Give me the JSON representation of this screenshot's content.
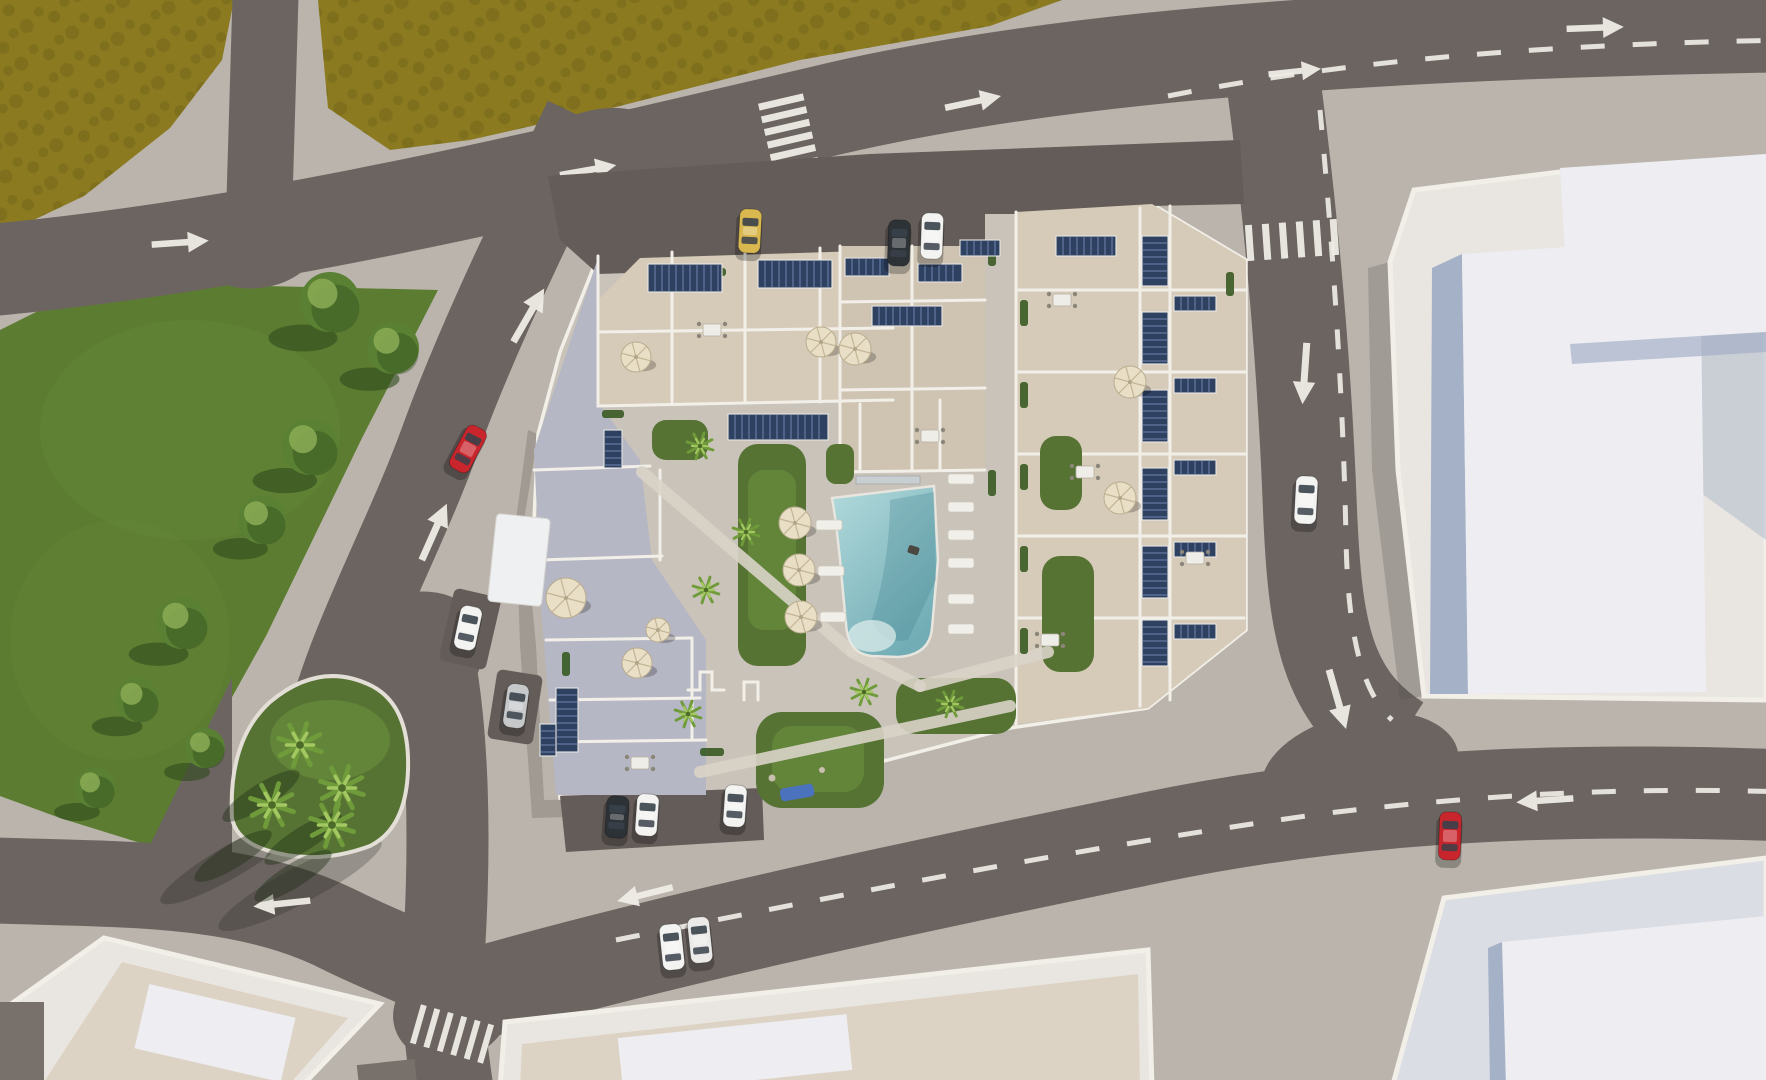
{
  "meta": {
    "scene_type": "aerial-architectural-render",
    "description": "Top-down 3D visualization of a residential apartment complex with rooftop terraces, solar panels, parasols and a central courtyard pool, surrounded by roads, a park and neighbouring flat-roof buildings",
    "visible_text": ""
  },
  "palette": {
    "sidewalk": "#bab4ac",
    "road": "#6b6460",
    "road_dark": "#635c58",
    "field": "#8b7a20",
    "field_dark": "#73651a",
    "park": "#5c7d31",
    "park_dark": "#35511f",
    "tree": "#59803306",
    "tree_fill": "#598033",
    "tree_dark": "#2e4a1d",
    "grass": "#567334",
    "grass_light": "#6e9340",
    "plot": "#c9c3b9",
    "beige": "#d6cbb9",
    "beige2": "#cfc4b2",
    "lilac": "#b6b7c4",
    "wall": "#f2efe9",
    "court_path": "#d9d3c8",
    "solar": "#2f4160",
    "solar_line": "#7b92bd",
    "pool_light": "#b2dadc",
    "pool_deep": "#72adb5",
    "pool_bar": "#c9ced1",
    "umbrella": "#e9dec6",
    "umbrella_line": "#c3b596",
    "bldg_white": "#e9e6e1",
    "roof_cream": "#ddd3c4",
    "lavender": "#dbdde4",
    "raised": "#ededf2",
    "shade_blue": "#a5b1c7",
    "marking": "#efece6"
  },
  "scene": {
    "cars": [
      {
        "name": "red-car-avenue",
        "color": "#c8252c",
        "x": 468,
        "y": 449,
        "rot": 28,
        "len": 48
      },
      {
        "name": "white-car-east-road",
        "color": "#f3f3f2",
        "x": 1306,
        "y": 500,
        "rot": 3,
        "len": 48
      },
      {
        "name": "red-car-bottom-road",
        "color": "#c8252c",
        "x": 1450,
        "y": 836,
        "rot": 2,
        "len": 48
      },
      {
        "name": "white-car-bottom-driving-1",
        "color": "#f3f3f2",
        "x": 672,
        "y": 947,
        "rot": -6,
        "len": 46
      },
      {
        "name": "white-car-bottom-driving-2",
        "color": "#eceae8",
        "x": 700,
        "y": 940,
        "rot": -6,
        "len": 46
      },
      {
        "name": "yellow-car-parked-north",
        "color": "#d9b84f",
        "x": 750,
        "y": 231,
        "rot": 3,
        "len": 44
      },
      {
        "name": "dark-car-parked-north",
        "color": "#2d3237",
        "x": 899,
        "y": 243,
        "rot": 2,
        "len": 46
      },
      {
        "name": "white-car-parked-north",
        "color": "#f3f3f2",
        "x": 932,
        "y": 236,
        "rot": 2,
        "len": 46
      },
      {
        "name": "white-car-parked-west-1",
        "color": "#f3f3f2",
        "x": 468,
        "y": 628,
        "rot": 12,
        "len": 44
      },
      {
        "name": "silver-car-parked-west-2",
        "color": "#c6c8ca",
        "x": 516,
        "y": 706,
        "rot": 8,
        "len": 44
      },
      {
        "name": "dark-car-parked-south",
        "color": "#2d3237",
        "x": 617,
        "y": 817,
        "rot": 4,
        "len": 42
      },
      {
        "name": "white-car-parked-south-1",
        "color": "#f3f3f2",
        "x": 647,
        "y": 815,
        "rot": 4,
        "len": 42
      },
      {
        "name": "white-car-parked-south-2",
        "color": "#f3f3f2",
        "x": 735,
        "y": 806,
        "rot": 4,
        "len": 42
      }
    ],
    "park_trees": [
      {
        "x": 330,
        "y": 302,
        "r": 30
      },
      {
        "x": 393,
        "y": 348,
        "r": 26
      },
      {
        "x": 310,
        "y": 447,
        "r": 28
      },
      {
        "x": 262,
        "y": 520,
        "r": 24
      },
      {
        "x": 182,
        "y": 623,
        "r": 26
      },
      {
        "x": 137,
        "y": 700,
        "r": 22
      },
      {
        "x": 205,
        "y": 748,
        "r": 20
      },
      {
        "x": 95,
        "y": 788,
        "r": 20
      }
    ],
    "island_palms": [
      {
        "x": 300,
        "y": 745
      },
      {
        "x": 342,
        "y": 788
      },
      {
        "x": 272,
        "y": 805
      },
      {
        "x": 332,
        "y": 825
      }
    ],
    "courtyard_palms": [
      {
        "x": 700,
        "y": 446
      },
      {
        "x": 746,
        "y": 532
      },
      {
        "x": 706,
        "y": 590
      },
      {
        "x": 864,
        "y": 692
      },
      {
        "x": 950,
        "y": 704
      },
      {
        "x": 688,
        "y": 714
      }
    ],
    "umbrellas": [
      {
        "x": 795,
        "y": 523,
        "r": 16
      },
      {
        "x": 799,
        "y": 570,
        "r": 16
      },
      {
        "x": 801,
        "y": 617,
        "r": 16
      },
      {
        "x": 566,
        "y": 598,
        "r": 20
      },
      {
        "x": 637,
        "y": 663,
        "r": 15
      },
      {
        "x": 658,
        "y": 630,
        "r": 12
      },
      {
        "x": 636,
        "y": 357,
        "r": 15
      },
      {
        "x": 821,
        "y": 342,
        "r": 15
      },
      {
        "x": 855,
        "y": 349,
        "r": 16
      },
      {
        "x": 1130,
        "y": 382,
        "r": 16
      },
      {
        "x": 1120,
        "y": 498,
        "r": 16
      }
    ],
    "solar_arrays": [
      {
        "x": 648,
        "y": 264,
        "w": 74,
        "h": 28
      },
      {
        "x": 758,
        "y": 260,
        "w": 74,
        "h": 28
      },
      {
        "x": 845,
        "y": 258,
        "w": 44,
        "h": 18
      },
      {
        "x": 918,
        "y": 264,
        "w": 44,
        "h": 18
      },
      {
        "x": 872,
        "y": 306,
        "w": 70,
        "h": 20
      },
      {
        "x": 728,
        "y": 414,
        "w": 100,
        "h": 26
      },
      {
        "x": 604,
        "y": 430,
        "w": 18,
        "h": 38
      },
      {
        "x": 556,
        "y": 688,
        "w": 22,
        "h": 64
      },
      {
        "x": 540,
        "y": 724,
        "w": 16,
        "h": 32
      },
      {
        "x": 1142,
        "y": 236,
        "w": 26,
        "h": 50
      },
      {
        "x": 1142,
        "y": 312,
        "w": 26,
        "h": 52
      },
      {
        "x": 1142,
        "y": 390,
        "w": 26,
        "h": 52
      },
      {
        "x": 1142,
        "y": 468,
        "w": 26,
        "h": 52
      },
      {
        "x": 1142,
        "y": 546,
        "w": 26,
        "h": 52
      },
      {
        "x": 1142,
        "y": 620,
        "w": 26,
        "h": 46
      },
      {
        "x": 1174,
        "y": 296,
        "w": 42,
        "h": 15
      },
      {
        "x": 1174,
        "y": 378,
        "w": 42,
        "h": 15
      },
      {
        "x": 1174,
        "y": 460,
        "w": 42,
        "h": 15
      },
      {
        "x": 1174,
        "y": 542,
        "w": 42,
        "h": 15
      },
      {
        "x": 1174,
        "y": 624,
        "w": 42,
        "h": 15
      },
      {
        "x": 1056,
        "y": 236,
        "w": 60,
        "h": 20
      },
      {
        "x": 960,
        "y": 240,
        "w": 40,
        "h": 16
      }
    ],
    "loungers": [
      {
        "x": 948,
        "y": 474
      },
      {
        "x": 948,
        "y": 502
      },
      {
        "x": 948,
        "y": 530
      },
      {
        "x": 948,
        "y": 558
      },
      {
        "x": 948,
        "y": 594
      },
      {
        "x": 948,
        "y": 624
      },
      {
        "x": 816,
        "y": 520
      },
      {
        "x": 818,
        "y": 566
      },
      {
        "x": 820,
        "y": 612
      }
    ],
    "tables": [
      {
        "x": 712,
        "y": 330
      },
      {
        "x": 1062,
        "y": 300
      },
      {
        "x": 1085,
        "y": 472
      },
      {
        "x": 1050,
        "y": 640
      },
      {
        "x": 1195,
        "y": 558
      },
      {
        "x": 640,
        "y": 763
      },
      {
        "x": 930,
        "y": 436
      }
    ],
    "hedges": [
      {
        "x": 1020,
        "y": 300,
        "w": 8,
        "h": 26
      },
      {
        "x": 1020,
        "y": 382,
        "w": 8,
        "h": 26
      },
      {
        "x": 1020,
        "y": 464,
        "w": 8,
        "h": 26
      },
      {
        "x": 1020,
        "y": 546,
        "w": 8,
        "h": 26
      },
      {
        "x": 1020,
        "y": 628,
        "w": 8,
        "h": 26
      },
      {
        "x": 700,
        "y": 268,
        "w": 26,
        "h": 8
      },
      {
        "x": 778,
        "y": 266,
        "w": 26,
        "h": 8
      },
      {
        "x": 602,
        "y": 410,
        "w": 22,
        "h": 8
      },
      {
        "x": 562,
        "y": 652,
        "w": 8,
        "h": 24
      },
      {
        "x": 700,
        "y": 748,
        "w": 24,
        "h": 8
      },
      {
        "x": 988,
        "y": 240,
        "w": 8,
        "h": 26
      },
      {
        "x": 988,
        "y": 470,
        "w": 8,
        "h": 26
      },
      {
        "x": 1226,
        "y": 272,
        "w": 8,
        "h": 24
      }
    ],
    "arrows": [
      {
        "x": 175,
        "y": 243,
        "rot": 86,
        "s": 1.3
      },
      {
        "x": 583,
        "y": 171,
        "rot": 80,
        "s": 1.3
      },
      {
        "x": 968,
        "y": 103,
        "rot": 78,
        "s": 1.3
      },
      {
        "x": 1290,
        "y": 72,
        "rot": 84,
        "s": 1.2
      },
      {
        "x": 1590,
        "y": 28,
        "rot": 88,
        "s": 1.3
      },
      {
        "x": 526,
        "y": 320,
        "rot": 30,
        "s": 1.4
      },
      {
        "x": 432,
        "y": 537,
        "rot": 24,
        "s": 1.4
      },
      {
        "x": 1305,
        "y": 368,
        "rot": 184,
        "s": 1.4
      },
      {
        "x": 1336,
        "y": 694,
        "rot": 164,
        "s": 1.4
      },
      {
        "x": 650,
        "y": 893,
        "rot": 256,
        "s": 1.3
      },
      {
        "x": 1550,
        "y": 800,
        "rot": 266,
        "s": 1.3
      },
      {
        "x": 287,
        "y": 903,
        "rot": 264,
        "s": 1.3
      }
    ],
    "crosswalks": [
      {
        "x": 790,
        "y": 140,
        "rot": -13,
        "n": 7,
        "len": 46,
        "th": 7,
        "gap": 6,
        "dir": "h"
      },
      {
        "x": 1292,
        "y": 240,
        "rot": -4,
        "n": 6,
        "len": 36,
        "th": 7,
        "gap": 10,
        "dir": "v"
      },
      {
        "x": 452,
        "y": 1034,
        "rot": 16,
        "n": 6,
        "len": 40,
        "th": 6,
        "gap": 8,
        "dir": "v"
      }
    ]
  }
}
